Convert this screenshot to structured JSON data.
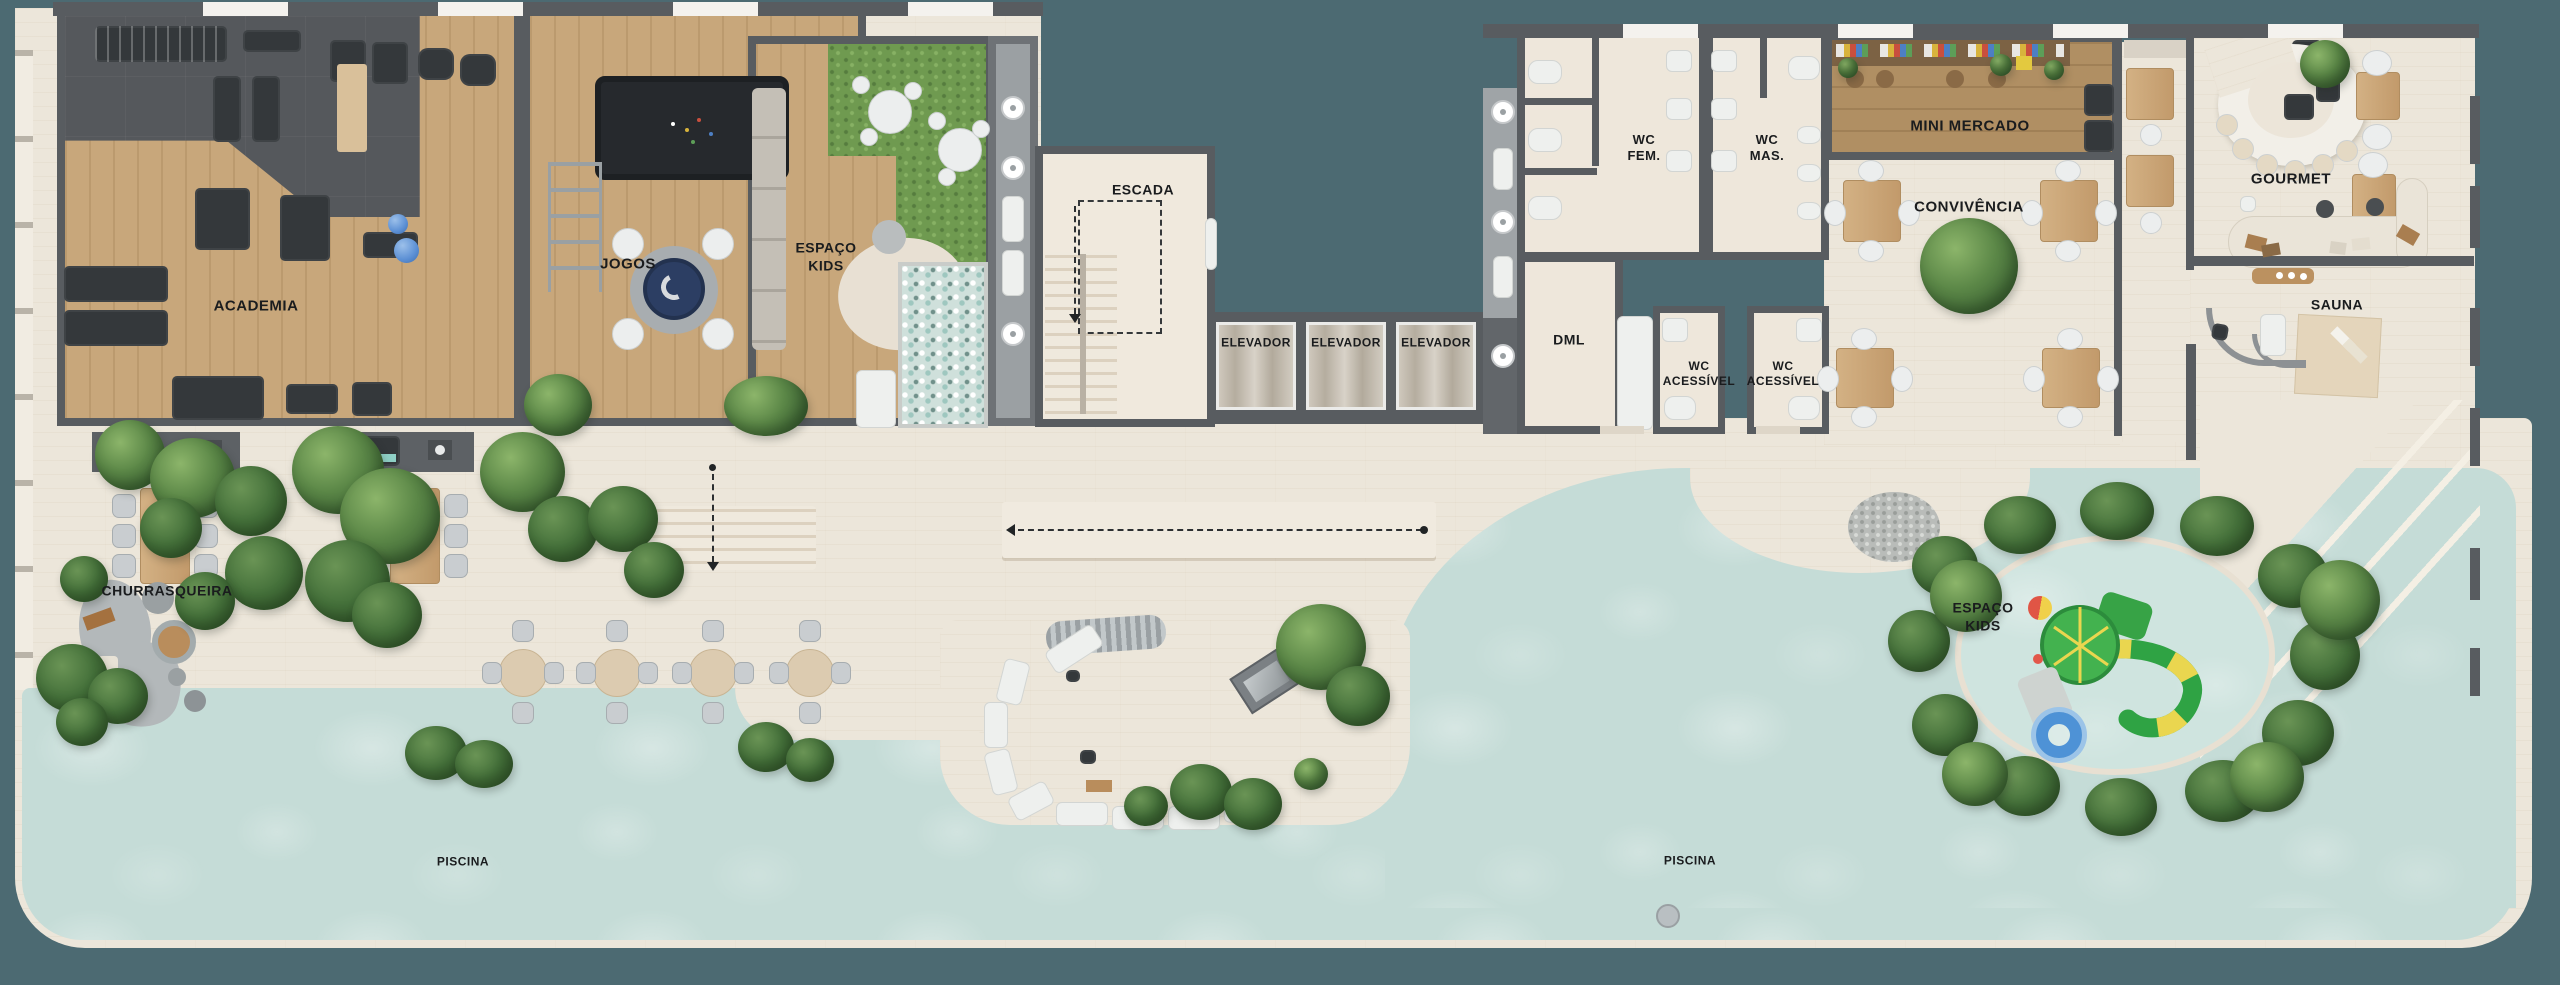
{
  "scene": {
    "type": "residential amenities floor plan (top-down render)",
    "palette": {
      "background": "#4c6a72",
      "deck": "#ece6da",
      "water": "#c5dcd7",
      "wall": "#585c60",
      "wood_floor": "#c8a77b",
      "market_wood": "#b08f63",
      "gym_rubber": "#55585c",
      "grass": "#6f9a50",
      "tree_green": "#4a7340",
      "slide_green": "#3fae4a",
      "slide_yellow": "#ead64f",
      "float_blue": "#4e92d6",
      "label_text": "#1a1c1e"
    }
  },
  "rooms": {
    "academia": {
      "label": "ACADEMIA"
    },
    "jogos": {
      "label": "JOGOS"
    },
    "espaco_kids_indoor": {
      "label_lines": [
        "ESPAÇO",
        "KIDS"
      ]
    },
    "escada": {
      "label": "ESCADA"
    },
    "elevadores": {
      "label": "ELEVADOR",
      "count": 3
    },
    "wc_fem": {
      "label_lines": [
        "WC",
        "FEM."
      ]
    },
    "wc_mas": {
      "label_lines": [
        "WC",
        "MAS."
      ]
    },
    "dml": {
      "label": "DML"
    },
    "wc_acessivel": {
      "label_lines": [
        "WC",
        "ACESSÍVEL"
      ],
      "count": 2
    },
    "mini_mercado": {
      "label": "MINI MERCADO"
    },
    "convivencia": {
      "label": "CONVIVÊNCIA"
    },
    "gourmet": {
      "label": "GOURMET"
    },
    "sauna": {
      "label": "SAUNA"
    },
    "churrasqueira": {
      "label": "CHURRASQUEIRA"
    },
    "espaco_kids_pool": {
      "label_lines": [
        "ESPAÇO",
        "KIDS"
      ]
    },
    "piscina": {
      "label": "PISCINA",
      "count": 2
    }
  }
}
